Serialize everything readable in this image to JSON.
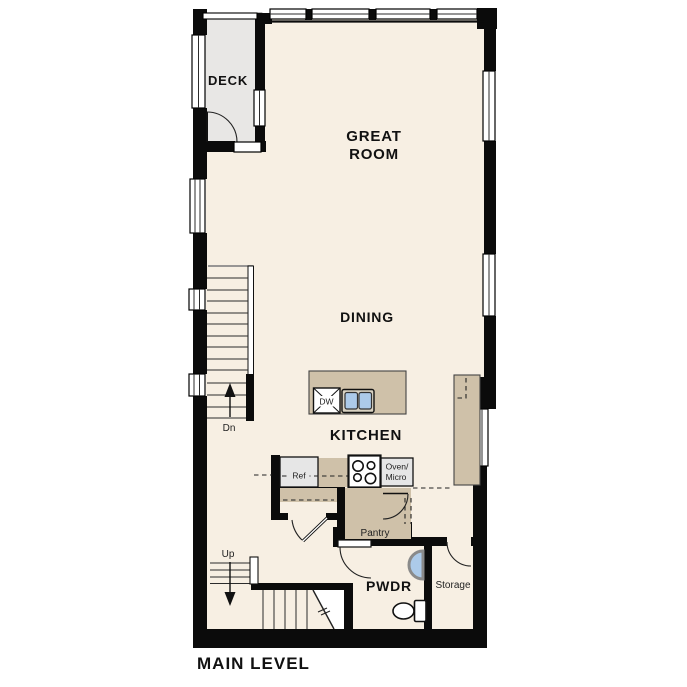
{
  "plan": {
    "title": "MAIN LEVEL",
    "rooms": {
      "deck": "DECK",
      "great_room_line1": "GREAT",
      "great_room_line2": "ROOM",
      "dining": "DINING",
      "kitchen": "KITCHEN",
      "powder": "PWDR",
      "pantry": "Pantry",
      "storage": "Storage"
    },
    "stairs": {
      "up_label": "Up",
      "down_label": "Dn"
    },
    "appliances": {
      "dishwasher": "DW",
      "refrigerator": "Ref",
      "oven_line1": "Oven/",
      "oven_line2": "Micro"
    },
    "colors": {
      "wall": "#0b0b0b",
      "floor": "#f7efe3",
      "deck": "#e8e7e5",
      "counter": "#cfc1a9",
      "appliance": "#e6e6e6",
      "sink_blue": "#accae9",
      "line": "#2b2b2b",
      "text": "#111111"
    }
  }
}
